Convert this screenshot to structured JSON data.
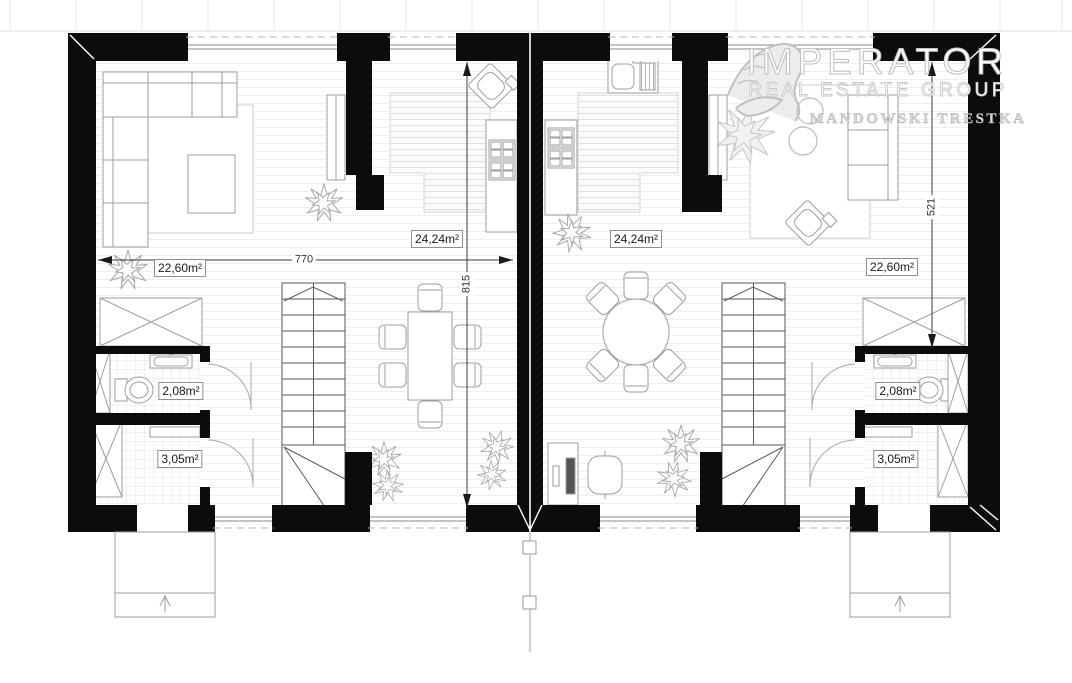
{
  "watermark": {
    "brand": "IMPERATOR",
    "subtitle": "REAL ESTATE GROUP",
    "names": "MANDOWSKI TRESTKA"
  },
  "dimension_labels": {
    "overall_width": "770",
    "overall_depth": "815",
    "right_wall_segment": "521"
  },
  "area_labels": {
    "left_unit": {
      "living_room": "22,60m²",
      "kitchen_dining": "24,24m²",
      "toilet": "2,08m²",
      "bathroom": "3,05m²"
    },
    "right_unit": {
      "living_room": "22,60m²",
      "kitchen_dining": "24,24m²",
      "toilet": "2,08m²",
      "bathroom": "3,05m²"
    }
  },
  "colors": {
    "walls": "#0c0c0c",
    "furniture_line": "#9e9e9e",
    "floor_line": "#efefef",
    "dimension_line": "#3c3c3c",
    "watermark_gray": "#c2c2c2"
  }
}
